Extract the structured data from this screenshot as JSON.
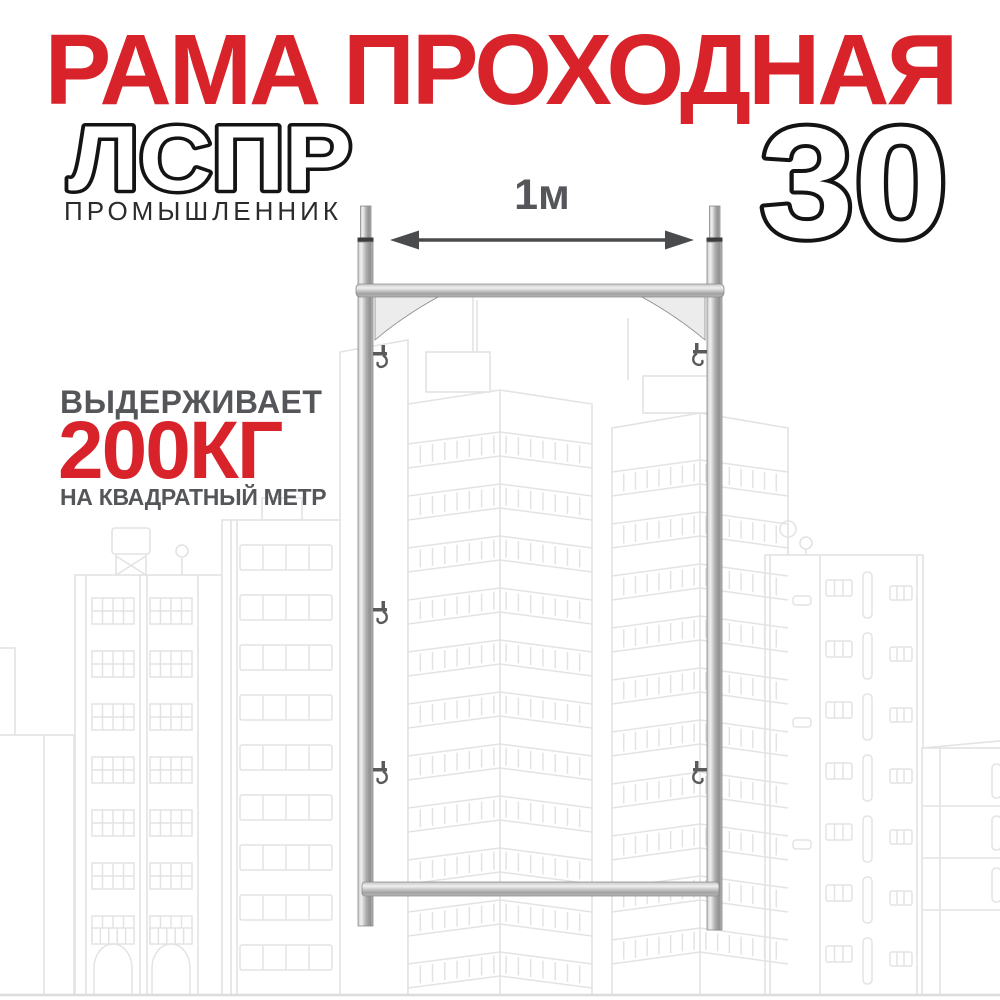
{
  "banner": {
    "title": "РАМА ПРОХОДНАЯ",
    "product_line": "ЛСПР",
    "brand": "ПРОМЫШЛЕННИК",
    "size_number": "30",
    "dimension_label": "1м",
    "capacity_intro": "ВЫДЕРЖИВАЕТ",
    "capacity_value": "200КГ",
    "capacity_unit": "НА КВАДРАТНЫЙ МЕТР"
  },
  "colors": {
    "accent_red": "#d9232b",
    "label_gray": "#55565a",
    "arrow_gray": "#4a4b4d",
    "brand_black": "#2b2b2b",
    "outline_black": "#141414",
    "sketch_gray": "#e3e3e3",
    "metal_gray": "#b5b5b5"
  },
  "icons": {
    "dimension_arrow": "double-headed-horizontal-arrow"
  }
}
